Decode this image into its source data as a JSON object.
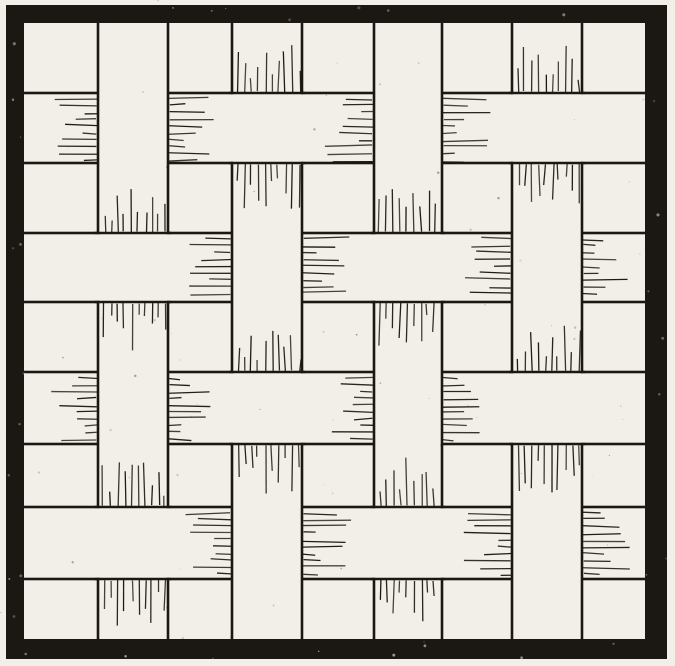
{
  "canvas": {
    "width": 675,
    "height": 666,
    "paper_color": "#f2efe9",
    "ink_color": "#1b1712"
  },
  "frame": {
    "outer": {
      "x": 6,
      "y": 5,
      "right": 667,
      "bottom": 659
    },
    "thickness": {
      "left": 18,
      "top": 18,
      "right": 22,
      "bottom": 20
    }
  },
  "weave": {
    "strip_line_width": 2.6,
    "vertical_strips": [
      {
        "x1": 98,
        "x2": 168
      },
      {
        "x1": 232,
        "x2": 302
      },
      {
        "x1": 374,
        "x2": 442
      },
      {
        "x1": 512,
        "x2": 582
      }
    ],
    "horizontal_strips": [
      {
        "y1": 93,
        "y2": 163
      },
      {
        "y1": 233,
        "y2": 302
      },
      {
        "y1": 372,
        "y2": 444
      },
      {
        "y1": 507,
        "y2": 579
      }
    ],
    "top_matrix": [
      [
        "V",
        "H",
        "V",
        "H"
      ],
      [
        "H",
        "V",
        "H",
        "V"
      ],
      [
        "V",
        "H",
        "V",
        "H"
      ],
      [
        "H",
        "V",
        "H",
        "V"
      ]
    ],
    "hatch": {
      "line_width": 1.3,
      "spacing": 6.8,
      "inset": 6,
      "min_len": 11,
      "max_len": 48,
      "seed": 1937
    }
  },
  "texture": {
    "paper_speck_count": 70,
    "frame_speck_count": 34,
    "seed": 41
  }
}
